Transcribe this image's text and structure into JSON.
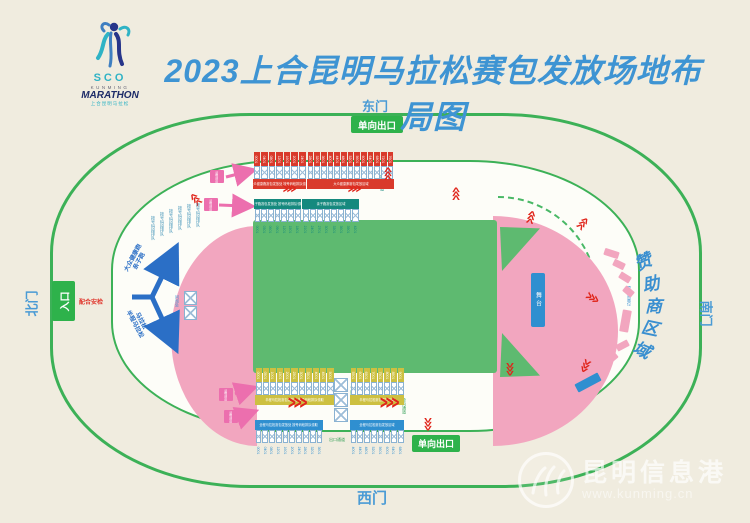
{
  "header": {
    "title": "2023上合昆明马拉松赛包发放场地布局图",
    "logo": {
      "sco": "SCO",
      "kunming": "KUNMING",
      "marathon": "MARATHON",
      "cn_name": "上合昆明马拉松"
    }
  },
  "gates": {
    "east": "东门",
    "west": "西门",
    "north": "北门",
    "south": "南门"
  },
  "badges": {
    "exit_top": "单向出口",
    "exit_bottom": "单向出口",
    "entrance": "入口",
    "security": "配合安检"
  },
  "flow": {
    "up_line1": "大众健康跑",
    "up_line2": "亲子跑",
    "down_line1": "马拉松",
    "down_line2": "半程马拉松"
  },
  "stage": {
    "label": "舞台"
  },
  "info_desk": {
    "label": "问询处"
  },
  "lane_labels": {
    "queue_lane": "排队通道",
    "service_lane": "专用通道",
    "exit_lane": "出口通道",
    "oneway_lane": "单向通道"
  },
  "queue_lines": [
    {
      "x": 150,
      "y": 216,
      "text": "按号码段排队"
    },
    {
      "x": 159,
      "y": 212,
      "text": "按号码段排队"
    },
    {
      "x": 168,
      "y": 209,
      "text": "按号码段排队"
    },
    {
      "x": 177,
      "y": 206,
      "text": "按号码段排队"
    },
    {
      "x": 186,
      "y": 204,
      "text": "按号码段排队"
    },
    {
      "x": 195,
      "y": 203,
      "text": "按号码段排队"
    }
  ],
  "pickup_tags": [
    {
      "x": 210,
      "y": 170,
      "text": "领物通道"
    },
    {
      "x": 204,
      "y": 198,
      "text": "领物通道"
    },
    {
      "x": 219,
      "y": 388,
      "text": "领物通道"
    },
    {
      "x": 224,
      "y": 410,
      "text": "领物通道"
    }
  ],
  "sponsor_area": {
    "label": "赞助商区域",
    "chars": [
      "赞",
      "助",
      "商",
      "区",
      "域"
    ],
    "char_pos": [
      {
        "x": 634,
        "y": 248,
        "r": -24
      },
      {
        "x": 642,
        "y": 270,
        "r": -12
      },
      {
        "x": 645,
        "y": 292,
        "r": 0
      },
      {
        "x": 642,
        "y": 314,
        "r": 12
      },
      {
        "x": 634,
        "y": 336,
        "r": 24
      }
    ],
    "booth_label": "赞助商展位",
    "booths": [
      {
        "x": 604,
        "y": 250,
        "w": 15,
        "h": 7,
        "r": 18
      },
      {
        "x": 613,
        "y": 261,
        "w": 12,
        "h": 7,
        "r": 26
      },
      {
        "x": 619,
        "y": 274,
        "w": 12,
        "h": 7,
        "r": 32
      },
      {
        "x": 623,
        "y": 288,
        "w": 11,
        "h": 7,
        "r": 40
      },
      {
        "x": 621,
        "y": 310,
        "w": 9,
        "h": 22,
        "r": 10
      },
      {
        "x": 616,
        "y": 342,
        "w": 13,
        "h": 7,
        "r": -28
      },
      {
        "x": 605,
        "y": 355,
        "w": 13,
        "h": 7,
        "r": -40
      },
      {
        "x": 592,
        "y": 367,
        "w": 13,
        "h": 7,
        "r": -52
      },
      {
        "x": 575,
        "y": 378,
        "w": 26,
        "h": 9,
        "r": -28,
        "blue": true
      }
    ]
  },
  "table_groups": [
    {
      "id": "red-1",
      "color": "red",
      "layout": "header-top",
      "x": 253,
      "y": 152,
      "w": 53,
      "cells": [
        "0001",
        "0401",
        "0801",
        "1201",
        "1601",
        "2001",
        "2401"
      ],
      "banner": "大众健康跑赛包发放处 按号码段排队领取"
    },
    {
      "id": "red-2",
      "color": "red",
      "layout": "header-top",
      "x": 307,
      "y": 152,
      "w": 87,
      "cells": [
        "2801",
        "3201",
        "3601",
        "4001",
        "4401",
        "4801",
        "5201",
        "5601",
        "6001",
        "6401",
        "6801",
        "7201",
        "7601"
      ],
      "banner": "大众健康跑赛包发放区域"
    },
    {
      "id": "teal-1",
      "color": "teal",
      "layout": "banner-top",
      "x": 254,
      "y": 199,
      "w": 47,
      "cells": [
        "0001",
        "0301",
        "0601",
        "0901",
        "1201",
        "1501",
        "1801"
      ],
      "banner": "亲子跑赛包发放处 按号码段排队领取"
    },
    {
      "id": "teal-2",
      "color": "teal",
      "layout": "banner-top",
      "x": 302,
      "y": 199,
      "w": 57,
      "cells": [
        "2101",
        "2401",
        "2701",
        "3001",
        "3301",
        "3601",
        "3901",
        "4201"
      ],
      "banner": "亲子跑赛包发放区域"
    },
    {
      "id": "yellow-1",
      "color": "yellow",
      "layout": "header-top",
      "x": 255,
      "y": 368,
      "w": 79,
      "cells": [
        "0001",
        "0501",
        "1001",
        "1501",
        "2001",
        "2501",
        "3001",
        "3501",
        "4001",
        "4501",
        "5001"
      ],
      "banner": "半程马拉松赛包发放处 按号码段排队领取"
    },
    {
      "id": "yellow-2",
      "color": "yellow",
      "layout": "header-top",
      "x": 350,
      "y": 368,
      "w": 54,
      "cells": [
        "5501",
        "6001",
        "6501",
        "7001",
        "7501",
        "8001",
        "8501",
        "9001"
      ],
      "banner": "半程马拉松赛包发放区域"
    },
    {
      "id": "blue-1",
      "color": "blue",
      "layout": "banner-top",
      "x": 255,
      "y": 420,
      "w": 68,
      "cells": [
        "0001",
        "0401",
        "0801",
        "1201",
        "1601",
        "2001",
        "2401",
        "2801",
        "3201",
        "3601"
      ],
      "banner": "全程马拉松赛包发放处 按号码段排队领取"
    },
    {
      "id": "blue-2",
      "color": "blue",
      "layout": "banner-top",
      "x": 350,
      "y": 420,
      "w": 54,
      "cells": [
        "4001",
        "4401",
        "4801",
        "5201",
        "5601",
        "6001",
        "6401",
        "6801"
      ],
      "banner": "全程马拉松赛包发放区域"
    }
  ],
  "center_stack": {
    "boxes": 3,
    "x": 333,
    "y": 378
  },
  "info_boxes": [
    {
      "x": 183,
      "y": 291
    },
    {
      "x": 183,
      "y": 306
    }
  ],
  "chevrons": [
    {
      "x": 283,
      "y": 186,
      "r": 0
    },
    {
      "x": 348,
      "y": 186,
      "r": 0
    },
    {
      "x": 384,
      "y": 170,
      "r": -90
    },
    {
      "x": 192,
      "y": 194,
      "r": -130
    },
    {
      "x": 452,
      "y": 190,
      "r": -90
    },
    {
      "x": 527,
      "y": 214,
      "r": -75
    },
    {
      "x": 578,
      "y": 221,
      "r": -50
    },
    {
      "x": 585,
      "y": 295,
      "r": 30
    },
    {
      "x": 578,
      "y": 360,
      "r": 115
    },
    {
      "x": 502,
      "y": 364,
      "r": 90
    },
    {
      "x": 288,
      "y": 397,
      "r": 0,
      "big": true
    },
    {
      "x": 380,
      "y": 397,
      "r": 0,
      "big": true
    },
    {
      "x": 420,
      "y": 419,
      "r": 90
    }
  ],
  "icons": {
    "flow_glyph": ">>>"
  },
  "watermark": {
    "name": "昆明信息港",
    "url": "www.kunming.cn"
  },
  "colors": {
    "background": "#f0ecdf",
    "track_line_green": "#3cb157",
    "badge_green": "#2eb24b",
    "stand_pink": "#f2a6bf",
    "infield_green": "#5eba70",
    "title_blue": "#3e94d3",
    "gate_blue": "#4a9bd5",
    "table_red": "#d93a2b",
    "table_teal": "#15897e",
    "table_yellow": "#cdc041",
    "table_blue": "#2f8fd0",
    "chevron_red": "#e0251b",
    "arrow_magenta": "#ec6fae",
    "flow_arrow_blue": "#2b6fc6"
  }
}
